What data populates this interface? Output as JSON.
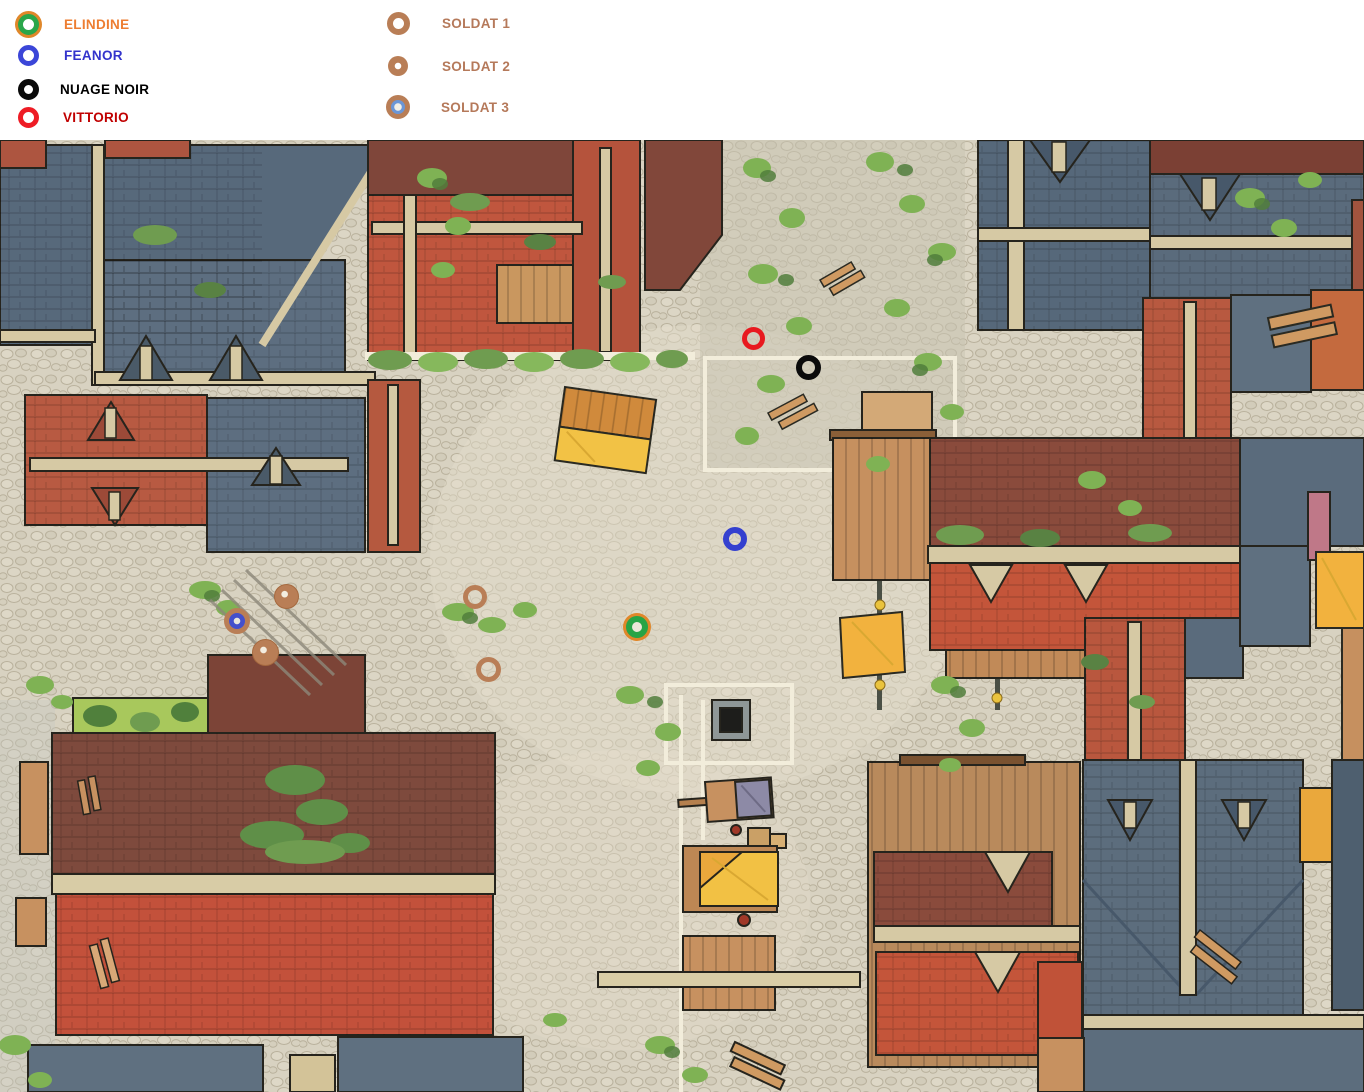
{
  "legend": {
    "characters": [
      {
        "id": "elindine",
        "label": "ELINDINE",
        "label_color": "#ED7D31",
        "icon": "green-ring-orange-outline-icon",
        "ring_color": "#2aa64a",
        "outer_ring_color": "#e0872a"
      },
      {
        "id": "feanor",
        "label": "FEANOR",
        "label_color": "#3333CC",
        "icon": "blue-ring-icon",
        "ring_color": "#3b46d8"
      },
      {
        "id": "nuage-noir",
        "label": "NUAGE NOIR",
        "label_color": "#000000",
        "icon": "black-ring-icon",
        "ring_color": "#0a0a0a"
      },
      {
        "id": "vittorio",
        "label": "VITTORIO",
        "label_color": "#C00000",
        "icon": "red-ring-icon",
        "ring_color": "#ee1c25"
      }
    ],
    "soldiers": [
      {
        "id": "soldat-1",
        "label": "SOLDAT 1",
        "label_color": "#B5795A",
        "icon": "tan-ring-icon",
        "ring_color": "#b97e56"
      },
      {
        "id": "soldat-2",
        "label": "SOLDAT 2",
        "label_color": "#B5795A",
        "icon": "tan-solid-white-dot-icon",
        "fill_color": "#b97e56"
      },
      {
        "id": "soldat-3",
        "label": "SOLDAT 3",
        "label_color": "#B5795A",
        "icon": "tan-ring-blue-core-icon",
        "ring_color": "#b97e56",
        "core_color": "#6b96d6",
        "map_core_color": "#4450cc"
      }
    ]
  },
  "map": {
    "description": "top-down fantasy town battle map with cobblestone streets, slate and terracotta roofs",
    "tokens": [
      {
        "name": "vittorio",
        "legend_ref": "VITTORIO",
        "type": "ring-red",
        "x": 753,
        "y": 338,
        "size": 23
      },
      {
        "name": "nuage-noir",
        "legend_ref": "NUAGE NOIR",
        "type": "ring-black",
        "x": 808,
        "y": 367,
        "size": 25
      },
      {
        "name": "feanor",
        "legend_ref": "FEANOR",
        "type": "ring-blue",
        "x": 735,
        "y": 539,
        "size": 24
      },
      {
        "name": "elindine",
        "legend_ref": "ELINDINE",
        "type": "ring-green-orange",
        "x": 637,
        "y": 627,
        "size": 22
      },
      {
        "name": "soldat-2-a",
        "legend_ref": "SOLDAT 2",
        "type": "solid-tan-dot",
        "x": 286,
        "y": 596,
        "size": 25
      },
      {
        "name": "soldat-3",
        "legend_ref": "SOLDAT 3",
        "type": "tan-ring-blue-core",
        "x": 237,
        "y": 621,
        "size": 26
      },
      {
        "name": "soldat-2-b",
        "legend_ref": "SOLDAT 2",
        "type": "solid-tan-dot",
        "x": 265,
        "y": 652,
        "size": 27
      },
      {
        "name": "soldat-1-a",
        "legend_ref": "SOLDAT 1",
        "type": "ring-tan",
        "x": 475,
        "y": 597,
        "size": 24
      },
      {
        "name": "soldat-1-b",
        "legend_ref": "SOLDAT 1",
        "type": "ring-tan",
        "x": 488,
        "y": 669,
        "size": 25
      }
    ],
    "palette": {
      "cobblestone": "#d8d2c1",
      "slate_roof": "#5a6b7c",
      "slate_dark": "#47586a",
      "red_roof": "#c4553a",
      "maroon_roof": "#7e4a3d",
      "brick_red": "#b85a42",
      "ridge_beam": "#d6c9a4",
      "wood": "#c6905f",
      "awning_yellow": "#f2c245",
      "awning_orange": "#eaa83c",
      "vegetation": "#7fb254",
      "vegetation_dark": "#517e3c"
    }
  }
}
